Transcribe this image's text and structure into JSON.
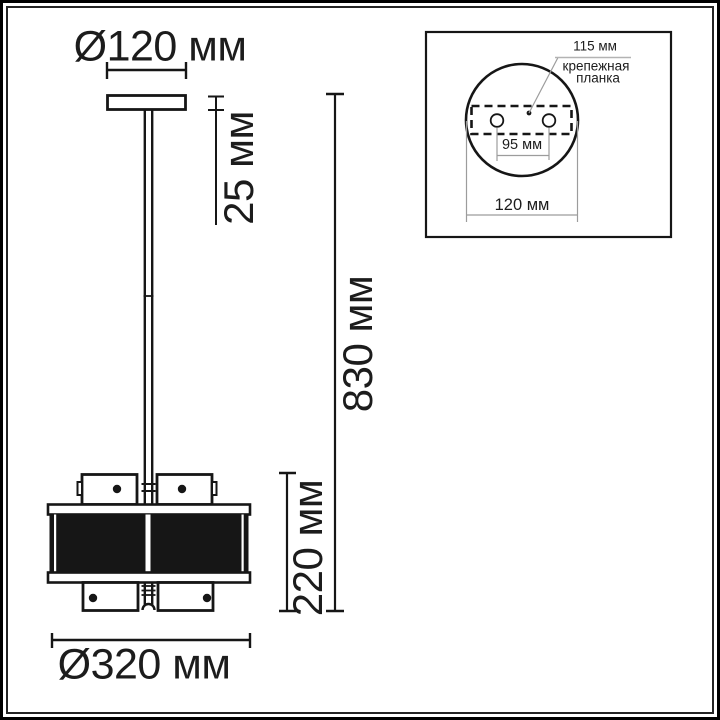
{
  "main_view": {
    "canopy_diameter_label": "Ø120 мм",
    "canopy_height_label": "25 мм",
    "total_height_label": "830 мм",
    "shade_height_label": "220 мм",
    "shade_diameter_label": "Ø320 мм"
  },
  "inset_view": {
    "bracket_width_label": "115 мм",
    "bracket_caption_line1": "крепежная",
    "bracket_caption_line2": "планка",
    "hole_spacing_label": "95 мм",
    "base_diameter_label": "120 мм"
  },
  "colors": {
    "line": "#161616",
    "text": "#1c1c1c",
    "inset_line_gray": "#9c9c9c",
    "background": "#ffffff"
  }
}
